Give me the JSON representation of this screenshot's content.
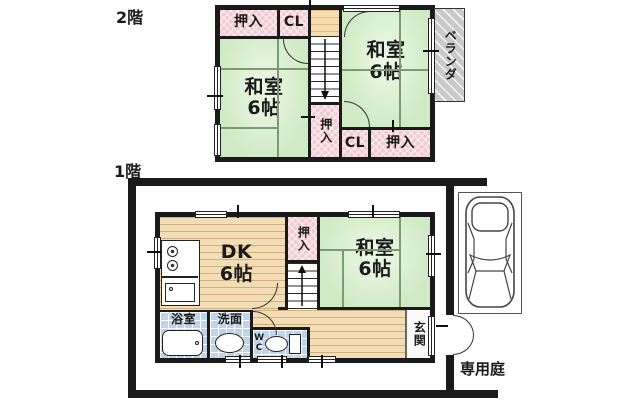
{
  "floor2": {
    "label": "2階",
    "closet_top_left": "押入",
    "closet_hall": "CL",
    "tatami_left_name": "和室",
    "tatami_left_size": "6帖",
    "tatami_right_name": "和室",
    "tatami_right_size": "6帖",
    "closet_stairs": "押入",
    "closet_south": "CL",
    "closet_south_east": "押入",
    "veranda": "ベランダ"
  },
  "floor1": {
    "label": "1階",
    "dk_name": "DK",
    "dk_size": "6帖",
    "closet": "押入",
    "tatami_name": "和室",
    "tatami_size": "6帖",
    "bath": "浴室",
    "washroom": "洗面",
    "wc": "WC",
    "entrance": "玄関",
    "garden": "専用庭"
  },
  "colors": {
    "wall": "#1a1a1a",
    "tatami": "#cfeac4",
    "closet": "#f5c9d2",
    "wood": "#f2ddb4",
    "tile": "#bdd4ec",
    "veranda": "#c9c9c9",
    "stair_landing": "#f7ddae"
  }
}
